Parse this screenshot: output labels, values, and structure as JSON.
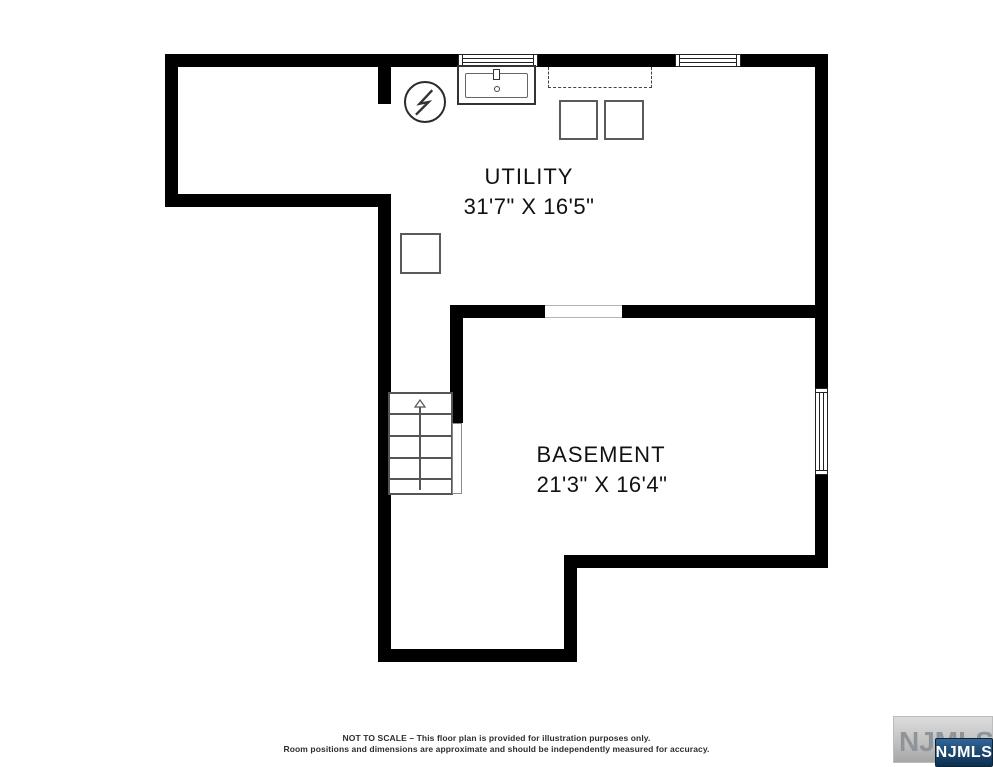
{
  "canvas": {
    "width": 993,
    "height": 767,
    "background": "#ffffff"
  },
  "colors": {
    "wall": "#000000",
    "fixture_line": "#5a5a5a",
    "window_line": "#222222",
    "badge_blue_top": "#336699",
    "badge_blue_bottom": "#0f3050",
    "watermark_text_gray": "#8e959a"
  },
  "rooms": [
    {
      "name": "UTILITY",
      "dimensions": "31'7\" X 16'5\""
    },
    {
      "name": "BASEMENT",
      "dimensions": "21'3\" X 16'4\""
    }
  ],
  "fixtures": {
    "icons": [
      "electrical-panel-icon",
      "lightning-bolt-icon",
      "laundry-sink-icon",
      "washer-box",
      "dryer-box",
      "support-post-box",
      "closet-dashed-outline",
      "stairs-up-arrow-icon",
      "window-icon"
    ]
  },
  "footer": {
    "line1": "NOT TO SCALE – This floor plan is provided for illustration purposes only.",
    "line2": "Room positions and dimensions are approximate and should be independently measured for accuracy."
  },
  "watermark": {
    "background_text": "NJMLS",
    "badge_text": "NJMLS"
  }
}
